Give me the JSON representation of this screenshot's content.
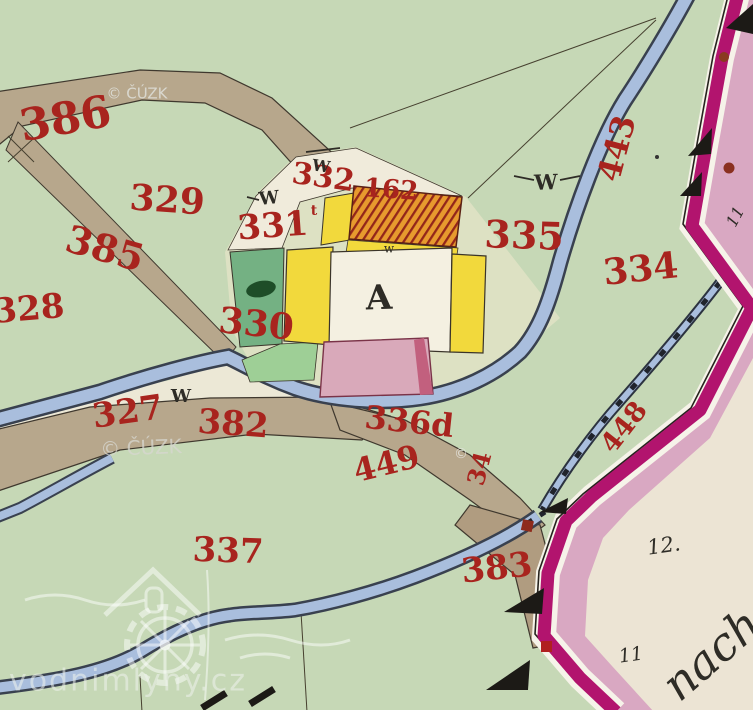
{
  "map_title": "Historical hand-coloured cadastral map sheet",
  "red_labels": [
    {
      "id": "parcel-386",
      "text": "386"
    },
    {
      "id": "parcel-329",
      "text": "329"
    },
    {
      "id": "parcel-385",
      "text": "385"
    },
    {
      "id": "parcel-328",
      "text": "328"
    },
    {
      "id": "parcel-330",
      "text": "330"
    },
    {
      "id": "parcel-331",
      "text": "331"
    },
    {
      "id": "parcel-331-sup",
      "text": "t"
    },
    {
      "id": "parcel-332",
      "text": "332"
    },
    {
      "id": "building-162",
      "text": "162"
    },
    {
      "id": "parcel-335",
      "text": "335"
    },
    {
      "id": "parcel-334",
      "text": "334"
    },
    {
      "id": "parcel-327",
      "text": "327"
    },
    {
      "id": "parcel-382",
      "text": "382"
    },
    {
      "id": "parcel-336d",
      "text": "336d"
    },
    {
      "id": "parcel-449",
      "text": "449"
    },
    {
      "id": "stream-443",
      "text": "443"
    },
    {
      "id": "stream-448",
      "text": "448"
    },
    {
      "id": "parcel-383",
      "text": "383"
    },
    {
      "id": "parcel-337",
      "text": "337"
    },
    {
      "id": "parcel-34",
      "text": "34"
    }
  ],
  "black_labels": [
    {
      "id": "courtyard-letter",
      "text": "A"
    },
    {
      "id": "meadow-mark-1",
      "text": "W"
    },
    {
      "id": "meadow-mark-2",
      "text": "W"
    },
    {
      "id": "meadow-mark-3",
      "text": "W"
    },
    {
      "id": "meadow-mark-4",
      "text": "W"
    },
    {
      "id": "small-w-mark",
      "text": "w"
    },
    {
      "id": "sheet-number-12",
      "text": "12."
    },
    {
      "id": "sheet-number-11",
      "text": "11"
    },
    {
      "id": "sheet-number-11-band",
      "text": "11"
    },
    {
      "id": "neighbour-sheet-text",
      "text": "nach"
    }
  ],
  "watermarks": [
    {
      "id": "cuzk-top",
      "text": "© ČÚZK"
    },
    {
      "id": "cuzk-middle",
      "text": "© ČÚZK"
    },
    {
      "id": "copyright-dot",
      "text": "©"
    },
    {
      "id": "vodnimlyny",
      "text": "vodnimlyny.cz"
    }
  ],
  "palette": {
    "background_green": "#c6d8b6",
    "road_brown": "#b7a78c",
    "stream_blue": "#a9bedd",
    "building_yellow": "#f2d93c",
    "building_pink": "#d9a9ba",
    "roof_orange": "#e79a2e",
    "garden_green": "#74b183",
    "boundary_magenta": "#b2146e",
    "band_pink": "#d9a8c2",
    "paper_cream": "#ece4d4",
    "label_red": "#a8241e",
    "ink_black": "#2e2c26"
  }
}
